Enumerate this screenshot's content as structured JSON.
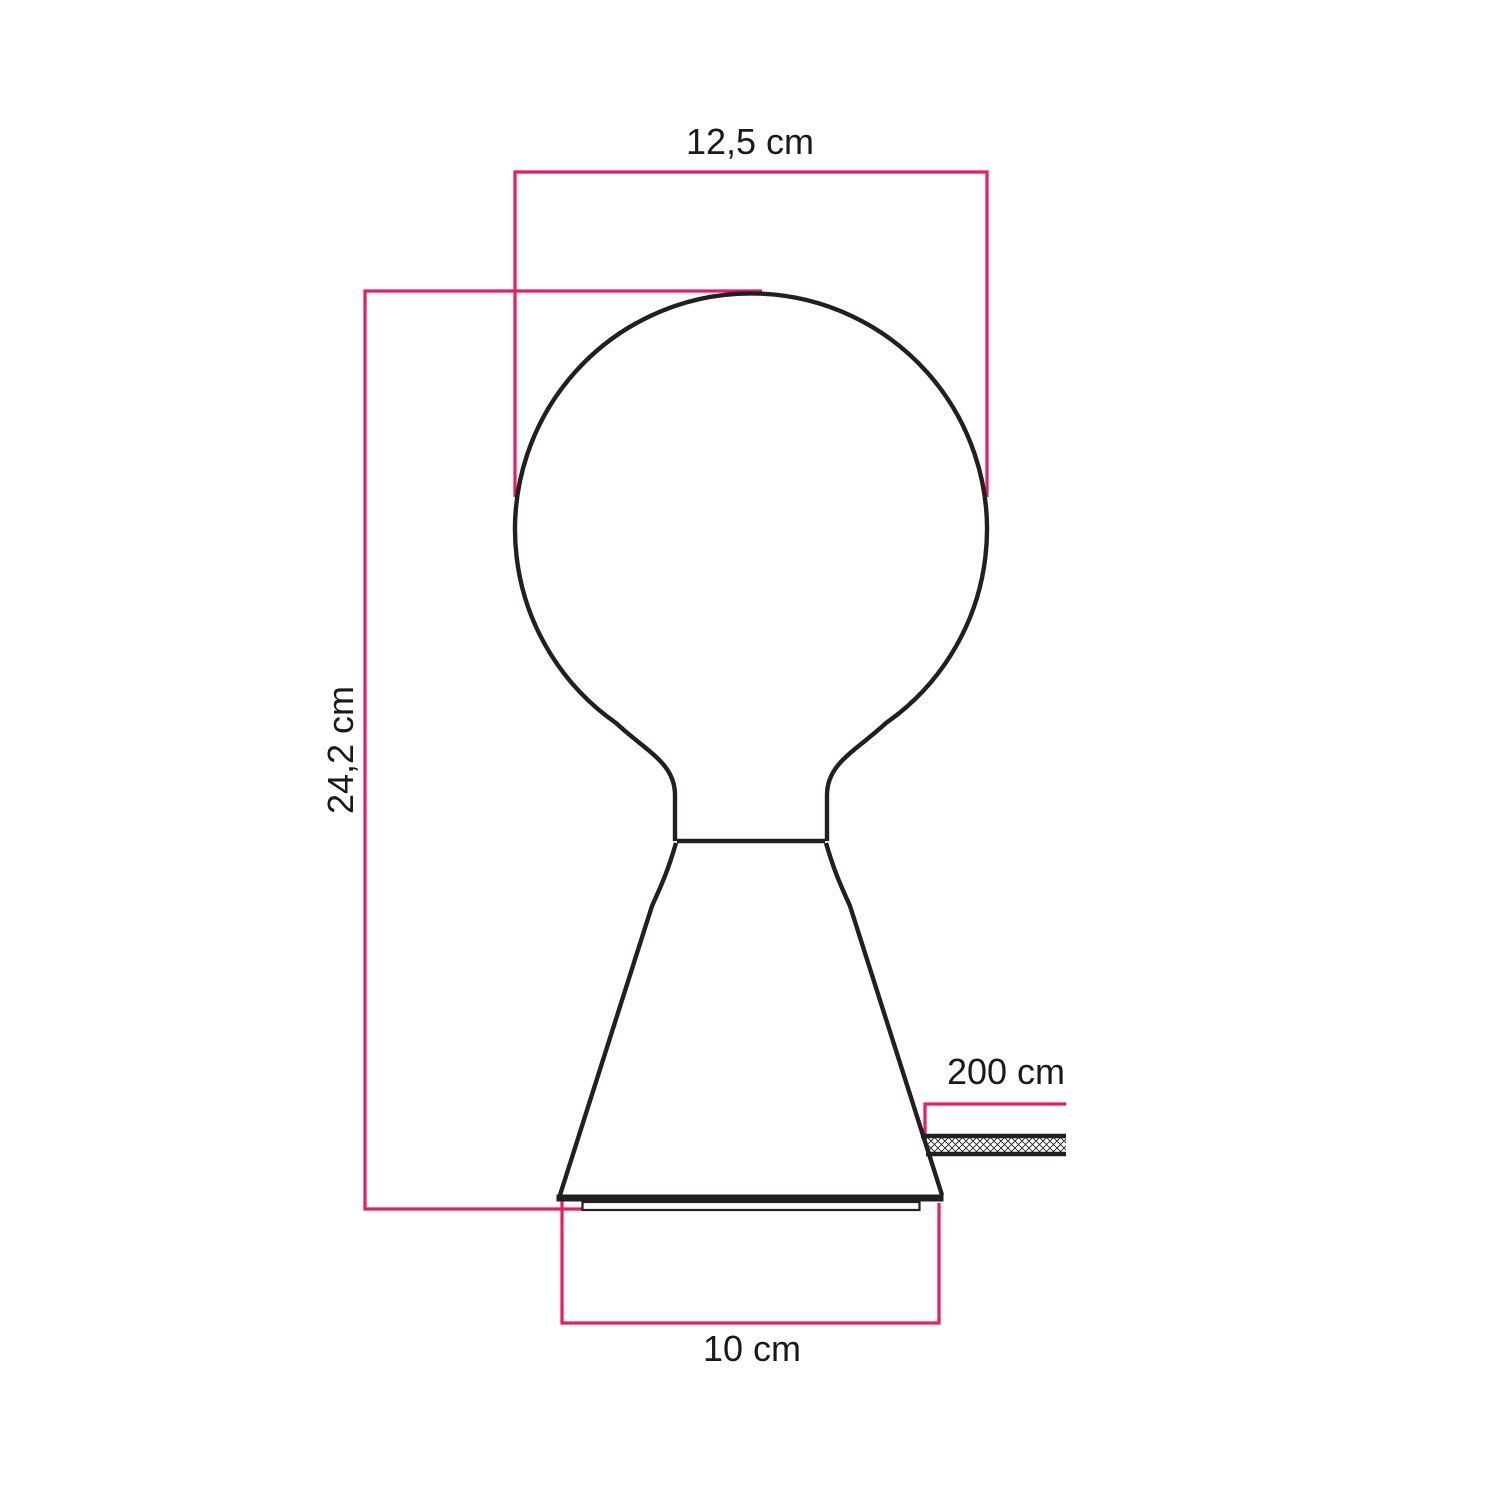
{
  "diagram": {
    "type": "product-dimension-drawing",
    "subject": "table lamp with globe bulb and conical base",
    "labels": {
      "bulb_width": "12,5 cm",
      "total_height": "24,2 cm",
      "cable_length": "200 cm",
      "base_width": "10 cm"
    }
  },
  "colors": {
    "dimension_line": "#EC1A5E",
    "outline": "#231F20",
    "background": "#FFFFFF",
    "text": "#1A1A1A"
  }
}
